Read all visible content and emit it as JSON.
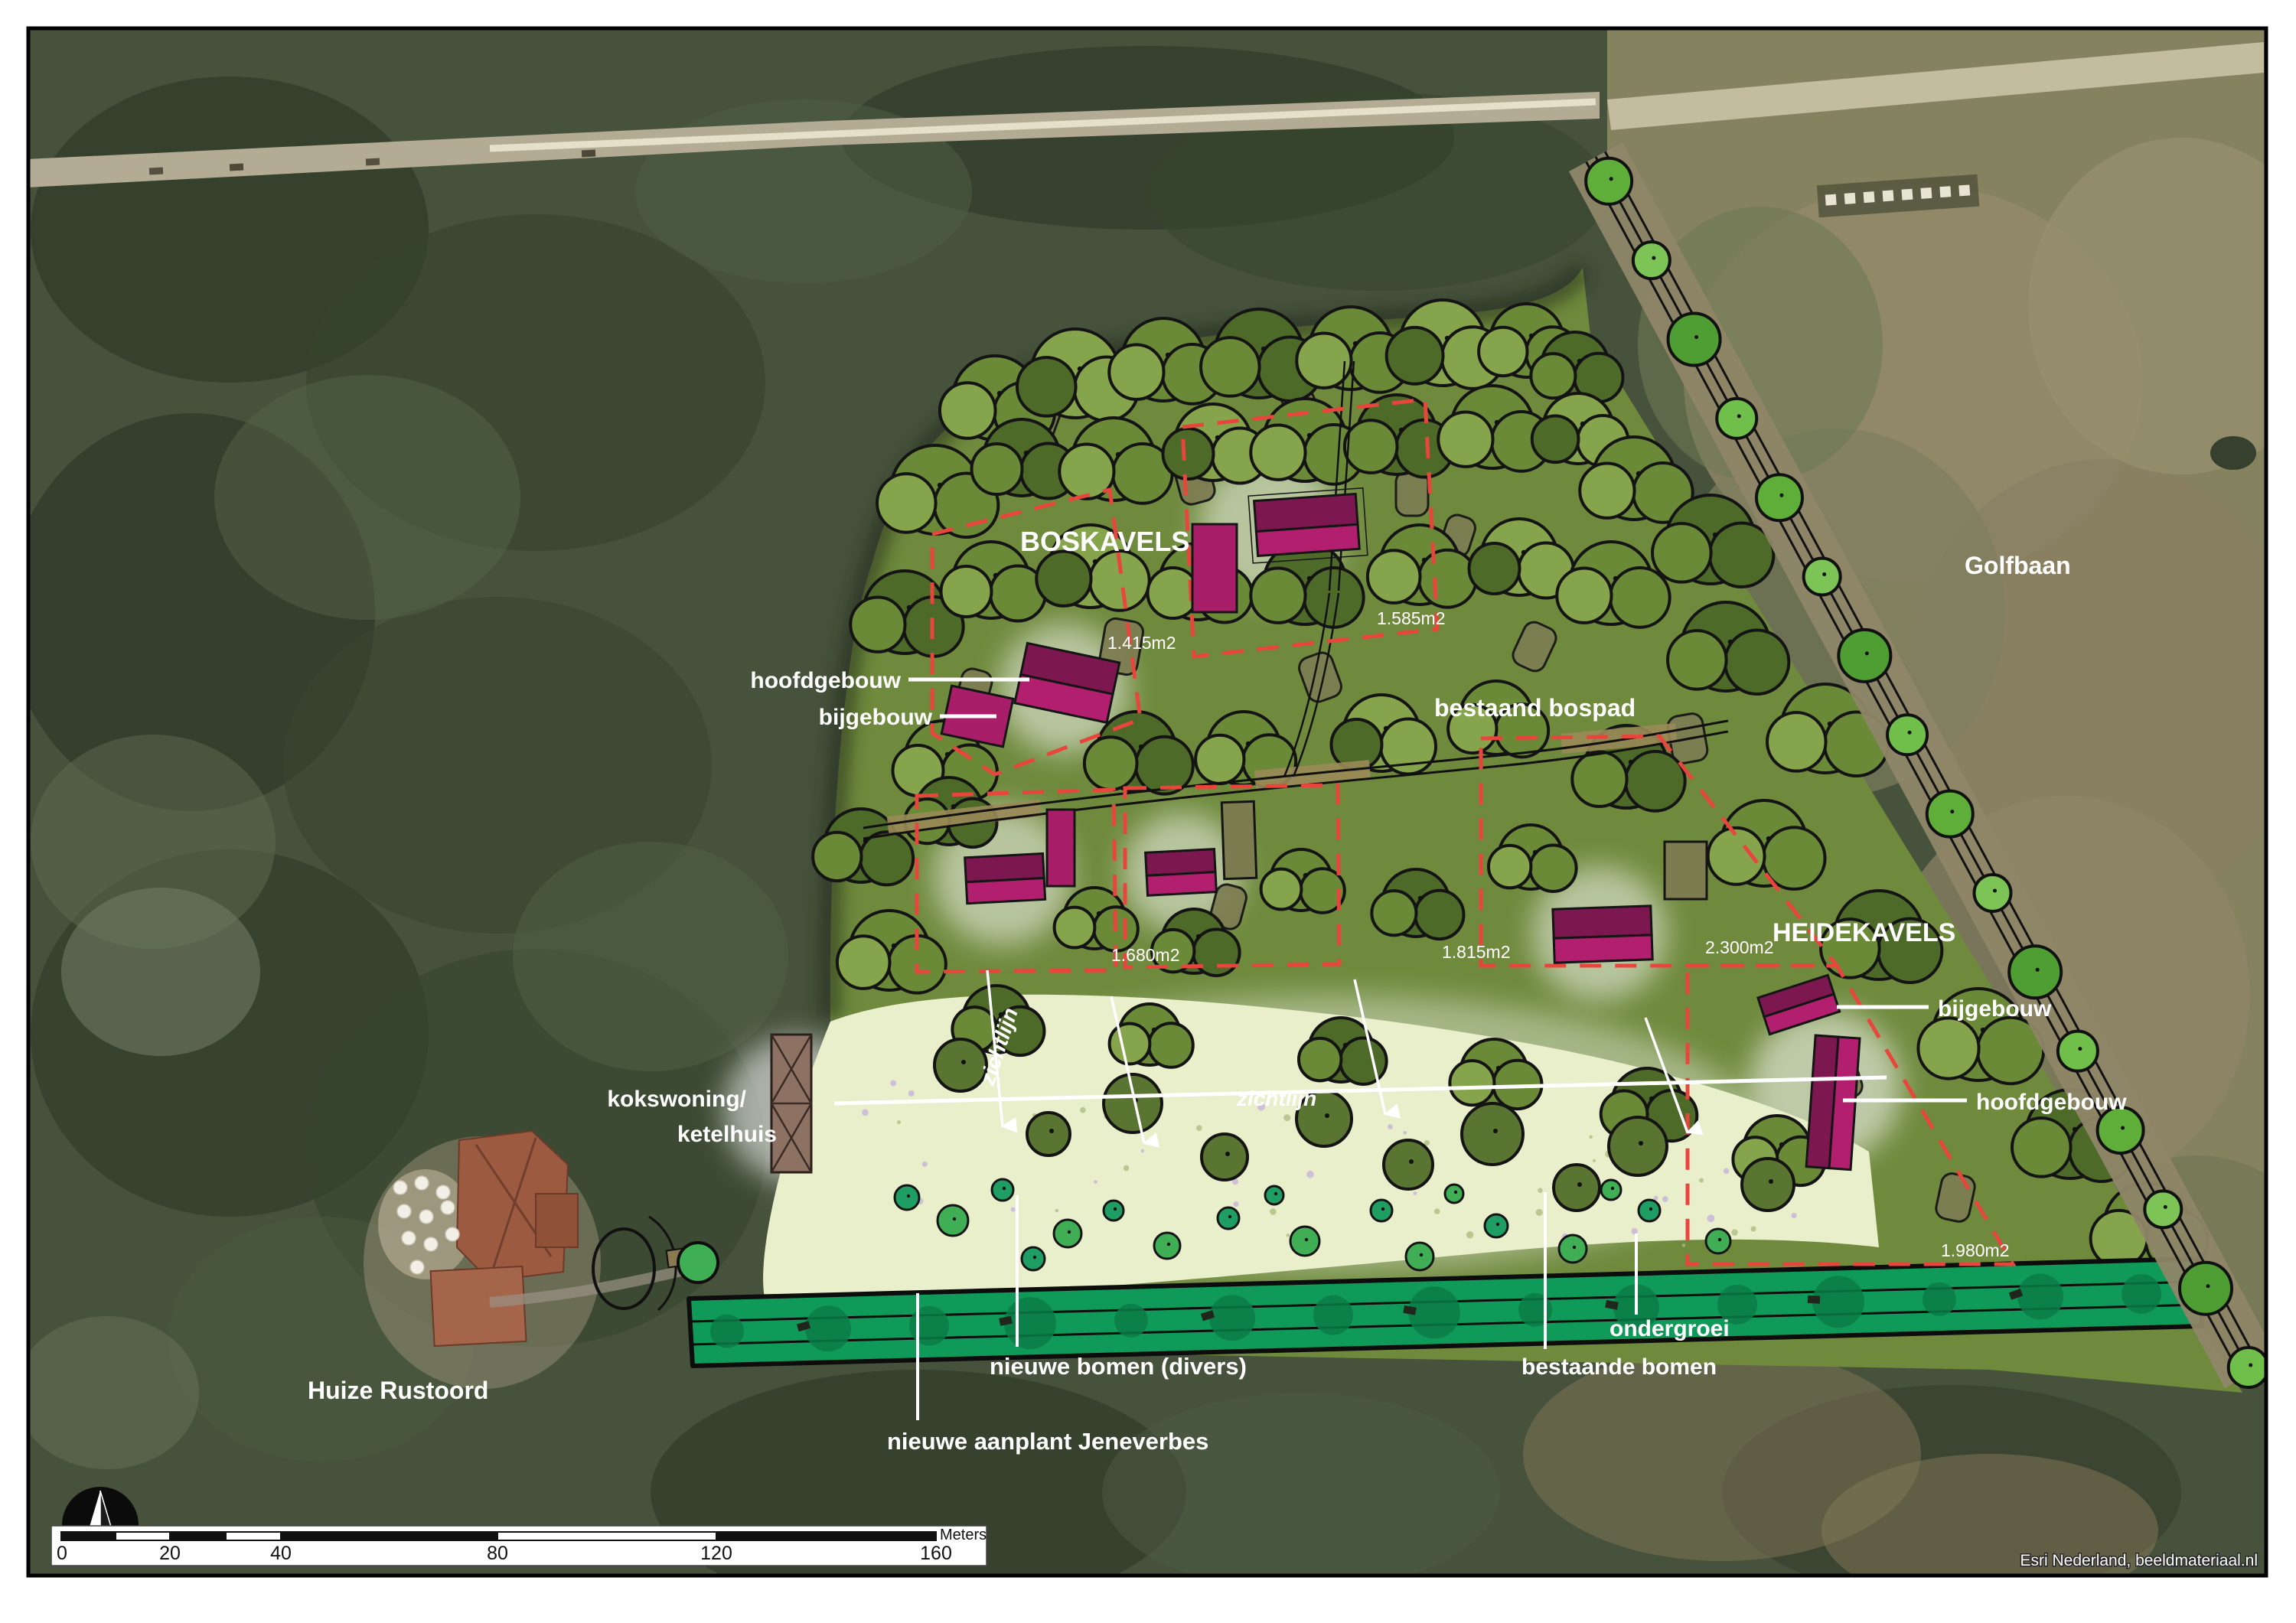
{
  "map": {
    "labels": {
      "boskavels": "BOSKAVELS",
      "heidekavels": "HEIDEKAVELS",
      "golfbaan": "Golfbaan",
      "huize_rustoord": "Huize Rustoord",
      "bestaand_bospad": "bestaand bospad",
      "hoofdgebouw_left": "hoofdgebouw",
      "bijgebouw_left": "bijgebouw",
      "bijgebouw_right": "bijgebouw",
      "hoofdgebouw_right": "hoofdgebouw",
      "kokswoning_line1": "kokswoning/",
      "kokswoning_line2": "ketelhuis",
      "zichtlijn_diagonal": "zichtlijn",
      "zichtlijn_horizontal": "zichtlijn",
      "nieuwe_bomen": "nieuwe bomen (divers)",
      "nieuwe_aanplant": "nieuwe aanplant Jeneverbes",
      "ondergroei": "ondergroei",
      "bestaande_bomen": "bestaande bomen"
    },
    "parcels": [
      {
        "name": "boskavel-west",
        "area": "1.415m2"
      },
      {
        "name": "boskavel-noord",
        "area": "1.585m2"
      },
      {
        "name": "kavel-midden-1",
        "area": "1.680m2"
      },
      {
        "name": "kavel-midden-2",
        "area": "1.815m2"
      },
      {
        "name": "heidekavel-groot",
        "area": "2.300m2"
      },
      {
        "name": "heidekavel-zuid",
        "area": "1.980m2"
      }
    ],
    "scale_bar": {
      "ticks": [
        "0",
        "20",
        "40",
        "80",
        "120",
        "160"
      ],
      "unit": "Meters"
    },
    "attribution": "Esri Nederland, beeldmateriaal.nl",
    "colors": {
      "parcel_boundary": "#e8453c",
      "building_dark": "#7d1750",
      "building_light": "#b21f6e",
      "hedge_green": "#109a5a",
      "heath": "#e9eecb",
      "site_green": "#6f8a3d",
      "label_text": "#ffffff"
    }
  }
}
